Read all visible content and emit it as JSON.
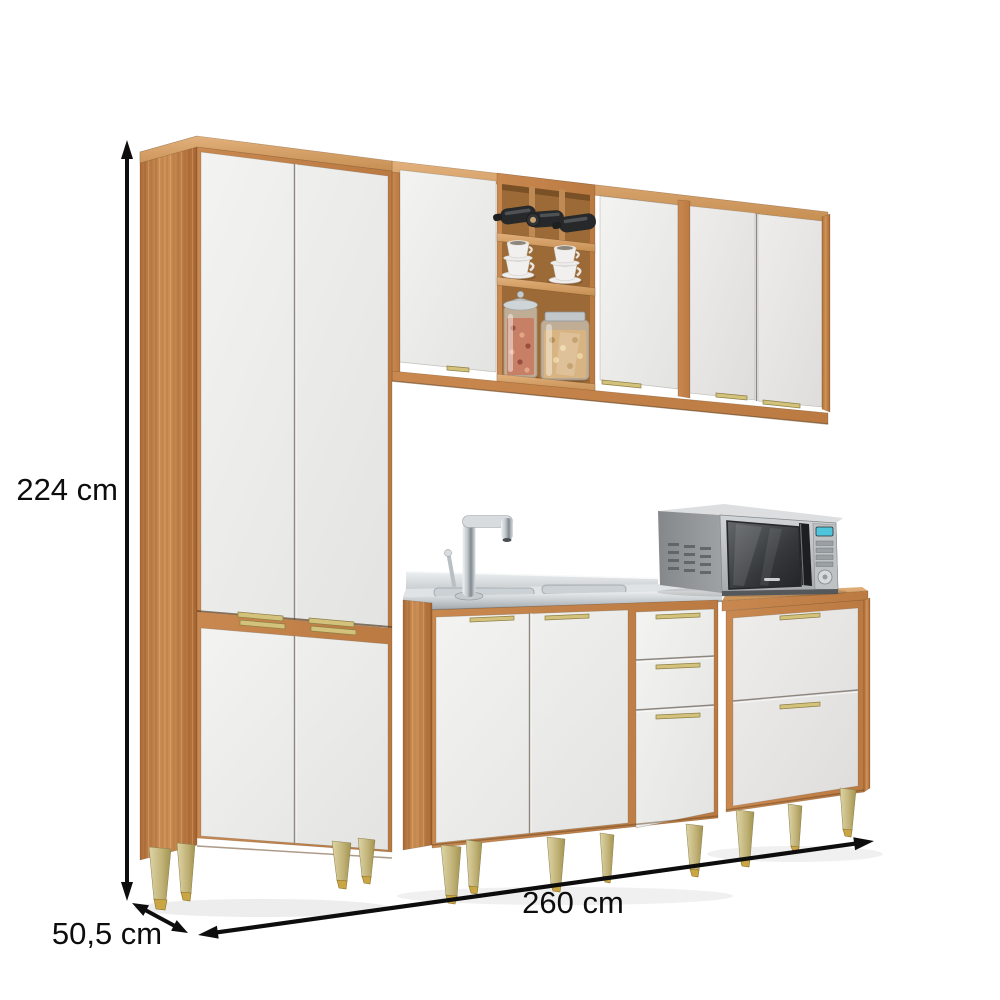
{
  "annotations": {
    "height_label": "224 cm",
    "width_label": "260 cm",
    "depth_label": "50,5 cm"
  },
  "scene": {
    "modules": [
      "tall-pantry-cabinet",
      "wall-cabinet",
      "sink-base-cabinet",
      "drawer-base-cabinet"
    ],
    "decor": {
      "wine_bottles": 3,
      "coffee_cup_stacks": 2,
      "food_jars": 2,
      "microwave": 1,
      "sink_faucet": 1
    }
  },
  "colors": {
    "background": "#ffffff",
    "wood": "#c5854d",
    "wood_dark": "#b06f3a",
    "wood_light": "#dca269",
    "door_white": "#efeeec",
    "handle_gold": "#d2c27c",
    "leg_gold": "#c0b176",
    "foot_brass": "#c9a544",
    "stainless_steel": "#c9ced1",
    "microwave_silver": "#b6b9bb",
    "dimension_line": "#111111"
  }
}
